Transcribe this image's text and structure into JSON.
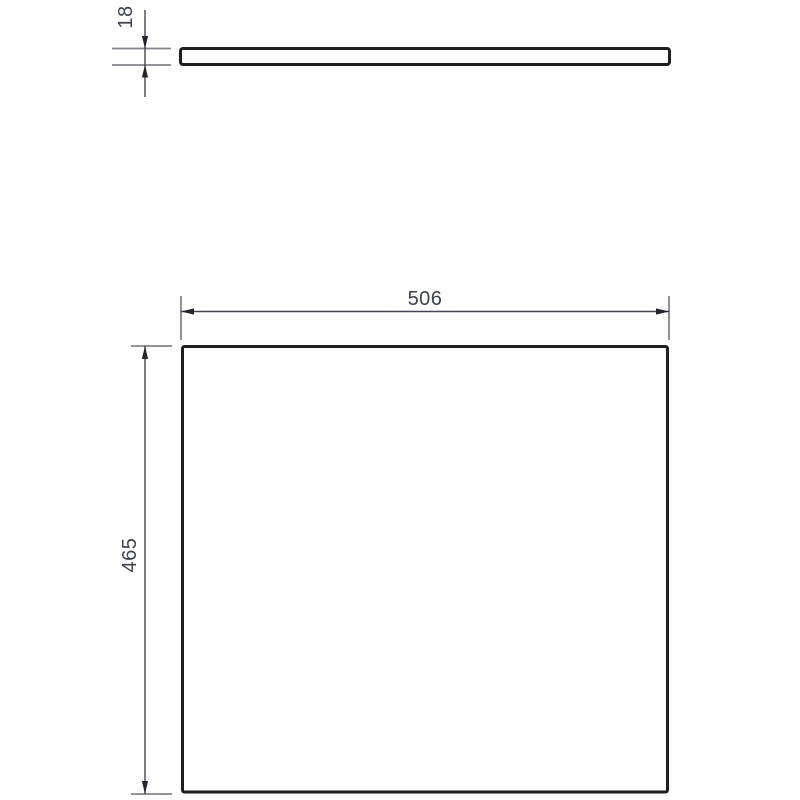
{
  "drawing": {
    "type": "technical-dimension-drawing",
    "top_view": {
      "thickness": "18"
    },
    "front_view": {
      "width": "506",
      "height": "465"
    }
  },
  "colors": {
    "outline": "#1e1e1e",
    "dimension_line": "#45454f",
    "extension_line": "#84848c",
    "arrow": "#23232b",
    "text": "#3c424b",
    "background": "#ffffff"
  }
}
